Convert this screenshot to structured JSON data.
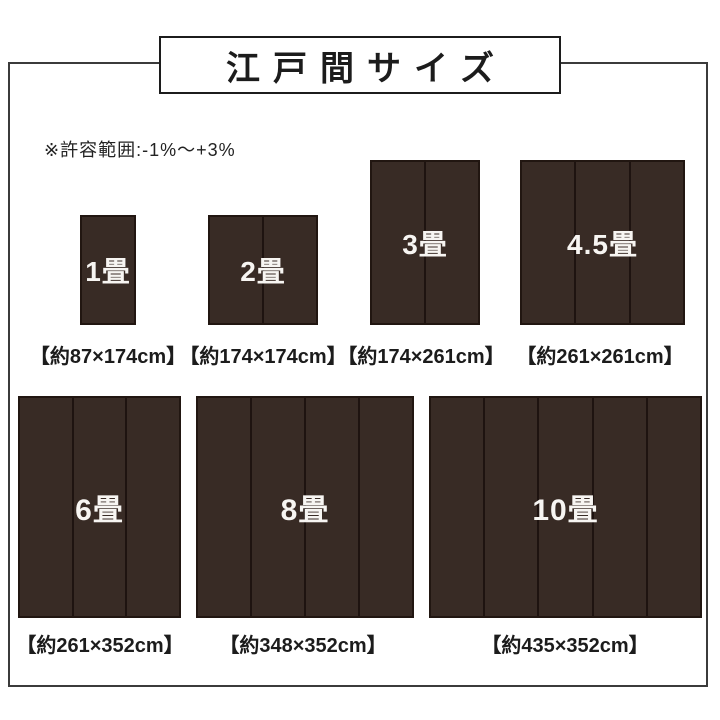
{
  "title": "江戸間サイズ",
  "note": "※許容範囲:-1%～+3%",
  "colors": {
    "rug_fill": "#382b25",
    "rug_seam": "#1e1310",
    "frame_border": "#3b3b3b",
    "title_border": "#1c1c1c",
    "label_text": "#f7f5f2",
    "text": "#1c1c1c"
  },
  "sizes": [
    {
      "label": "1畳",
      "dims": "【約87×174cm】",
      "panels": 1
    },
    {
      "label": "2畳",
      "dims": "【約174×174cm】",
      "panels": 2
    },
    {
      "label": "3畳",
      "dims": "【約174×261cm】",
      "panels": 2
    },
    {
      "label": "4.5畳",
      "dims": "【約261×261cm】",
      "panels": 3
    },
    {
      "label": "6畳",
      "dims": "【約261×352cm】",
      "panels": 3
    },
    {
      "label": "8畳",
      "dims": "【約348×352cm】",
      "panels": 4
    },
    {
      "label": "10畳",
      "dims": "【約435×352cm】",
      "panels": 5
    }
  ]
}
